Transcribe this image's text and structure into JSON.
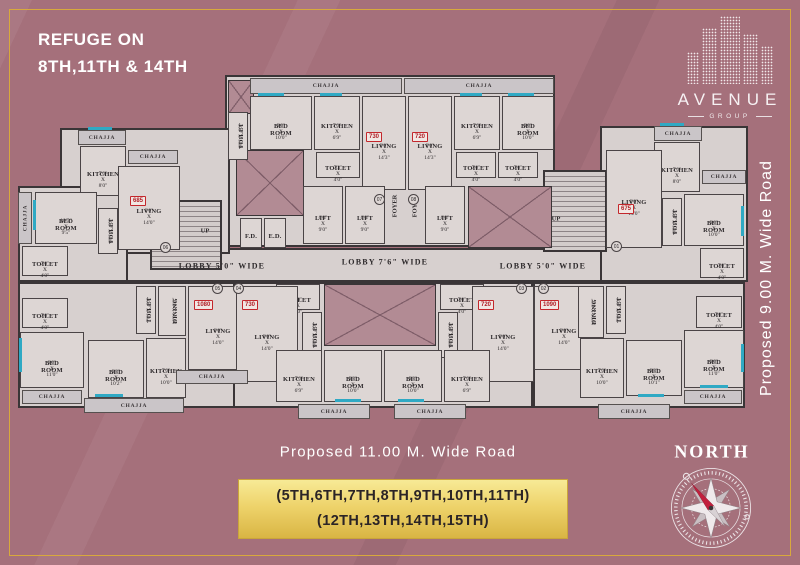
{
  "header": {
    "refuge_line1": "REFUGE ON",
    "refuge_line2": "8TH,11TH & 14TH"
  },
  "logo": {
    "name": "AVENUE",
    "sub": "GROUP"
  },
  "roads": {
    "right": "Proposed 9.00 M. Wide Road",
    "bottom": "Proposed 11.00 M. Wide Road"
  },
  "banner": {
    "line1": "(5TH,6TH,7TH,8TH,9TH,10TH,11TH)",
    "line2": "(12TH,13TH,14TH,15TH)"
  },
  "compass": {
    "label": "NORTH"
  },
  "colors": {
    "background": "#a5707b",
    "gold_frame": "#d8a93c",
    "wall": "#3a3537",
    "floor": "#d7d0cf",
    "room": "#ddd6d4",
    "chajja": "#cac5c8",
    "shaft": "#b28b94",
    "area_red": "#c3272c",
    "window_teal": "#2fa9c4",
    "banner_gold": "#eed36b"
  },
  "plan": {
    "chajja_label": "CHAJJA",
    "blocks": [
      {
        "x": 225,
        "y": 75,
        "w": 330,
        "h": 172
      },
      {
        "x": 85,
        "y": 248,
        "w": 580,
        "h": 34
      },
      {
        "x": 60,
        "y": 128,
        "w": 170,
        "h": 126
      },
      {
        "x": 18,
        "y": 186,
        "w": 110,
        "h": 96
      },
      {
        "x": 18,
        "y": 282,
        "w": 230,
        "h": 126
      },
      {
        "x": 233,
        "y": 282,
        "w": 300,
        "h": 126
      },
      {
        "x": 533,
        "y": 282,
        "w": 212,
        "h": 126
      },
      {
        "x": 600,
        "y": 126,
        "w": 148,
        "h": 156
      },
      {
        "x": 150,
        "y": 200,
        "w": 72,
        "h": 70,
        "kind": "stairs"
      },
      {
        "x": 543,
        "y": 170,
        "w": 64,
        "h": 82,
        "kind": "stairs"
      }
    ],
    "shafts": [
      {
        "x": 228,
        "y": 80,
        "w": 26,
        "h": 34
      },
      {
        "x": 236,
        "y": 150,
        "w": 68,
        "h": 66
      },
      {
        "x": 468,
        "y": 186,
        "w": 84,
        "h": 62
      },
      {
        "x": 324,
        "y": 284,
        "w": 112,
        "h": 62
      }
    ],
    "rooms": [
      {
        "label": "BED ROOM",
        "dims": "9'0\" X 10'0\"",
        "x": 250,
        "y": 96,
        "w": 62,
        "h": 54
      },
      {
        "label": "KITCHEN",
        "dims": "7'0\" X 6'9\"",
        "x": 314,
        "y": 96,
        "w": 46,
        "h": 54
      },
      {
        "label": "LIVING",
        "dims": "9'0\" X 14'3\"",
        "x": 362,
        "y": 96,
        "w": 44,
        "h": 94
      },
      {
        "label": "TOILET",
        "dims": "7'3\" X 4'0\"",
        "x": 316,
        "y": 152,
        "w": 44,
        "h": 26
      },
      {
        "label": "TOILET",
        "dims": "6'0\" X 4'0\"",
        "x": 228,
        "y": 112,
        "w": 20,
        "h": 48,
        "vert": true
      },
      {
        "label": "LIVING",
        "dims": "9'0\" X 14'3\"",
        "x": 408,
        "y": 96,
        "w": 44,
        "h": 94
      },
      {
        "label": "KITCHEN",
        "dims": "7'0\" X 6'9\"",
        "x": 454,
        "y": 96,
        "w": 46,
        "h": 54
      },
      {
        "label": "BED ROOM",
        "dims": "9'0\" X 10'0\"",
        "x": 502,
        "y": 96,
        "w": 52,
        "h": 54
      },
      {
        "label": "TOILET",
        "dims": "7'0\" X 4'0\"",
        "x": 456,
        "y": 152,
        "w": 40,
        "h": 26
      },
      {
        "label": "TOILET",
        "dims": "7'0\" X 4'0\"",
        "x": 498,
        "y": 152,
        "w": 40,
        "h": 26
      },
      {
        "label": "LIFT",
        "dims": "6'0\" X 9'0\"",
        "x": 303,
        "y": 186,
        "w": 40,
        "h": 58
      },
      {
        "label": "LIFT",
        "dims": "6'0\" X 9'0\"",
        "x": 345,
        "y": 186,
        "w": 40,
        "h": 58
      },
      {
        "label": "LIFT",
        "dims": "6'0\" X 9'0\"",
        "x": 425,
        "y": 186,
        "w": 40,
        "h": 58
      },
      {
        "label": "F.D.",
        "dims": "",
        "x": 240,
        "y": 218,
        "w": 22,
        "h": 30
      },
      {
        "label": "E.D.",
        "dims": "",
        "x": 264,
        "y": 218,
        "w": 22,
        "h": 30
      },
      {
        "label": "KITCHEN",
        "dims": "7'0\" X 8'0\"",
        "x": 80,
        "y": 146,
        "w": 46,
        "h": 50
      },
      {
        "label": "LIVING",
        "dims": "9'0\" X 14'0\"",
        "x": 118,
        "y": 166,
        "w": 62,
        "h": 84
      },
      {
        "label": "BED ROOM",
        "dims": "10'5\" X 9'5\"",
        "x": 35,
        "y": 192,
        "w": 62,
        "h": 52
      },
      {
        "label": "TOILET",
        "dims": "6'0\" X 4'0\"",
        "x": 98,
        "y": 208,
        "w": 20,
        "h": 46,
        "vert": true
      },
      {
        "label": "TOILET",
        "dims": "7'0\" X 4'0\"",
        "x": 22,
        "y": 246,
        "w": 46,
        "h": 30
      },
      {
        "label": "TOILET",
        "dims": "7'0\" X 4'0\"",
        "x": 22,
        "y": 298,
        "w": 46,
        "h": 30
      },
      {
        "label": "BED ROOM",
        "dims": "9'0\" X 11'0\"",
        "x": 20,
        "y": 332,
        "w": 64,
        "h": 56
      },
      {
        "label": "BED ROOM",
        "dims": "9'3\" X 10'2\"",
        "x": 88,
        "y": 340,
        "w": 56,
        "h": 58
      },
      {
        "label": "KITCHEN",
        "dims": "7'0\" X 10'0\"",
        "x": 146,
        "y": 338,
        "w": 40,
        "h": 60
      },
      {
        "label": "DINING",
        "dims": "10'3\" X 8'0\"",
        "x": 158,
        "y": 286,
        "w": 28,
        "h": 50,
        "vert": true
      },
      {
        "label": "TOILET",
        "dims": "7'0\" X 4'0\"",
        "x": 136,
        "y": 286,
        "w": 20,
        "h": 48,
        "vert": true
      },
      {
        "label": "LIVING",
        "dims": "9'0\" X 14'0\"",
        "x": 188,
        "y": 286,
        "w": 60,
        "h": 84
      },
      {
        "label": "TOILET",
        "dims": "7'0\" X 4'0\"",
        "x": 276,
        "y": 284,
        "w": 44,
        "h": 26
      },
      {
        "label": "TOILET",
        "dims": "7'0\" X 4'0\"",
        "x": 440,
        "y": 284,
        "w": 44,
        "h": 26
      },
      {
        "label": "TOILET",
        "dims": "6'0\" X 4'0\"",
        "x": 302,
        "y": 312,
        "w": 20,
        "h": 46,
        "vert": true
      },
      {
        "label": "TOILET",
        "dims": "6'0\" X 4'0\"",
        "x": 438,
        "y": 312,
        "w": 20,
        "h": 46,
        "vert": true
      },
      {
        "label": "LIVING",
        "dims": "9'0\" X 14'0\"",
        "x": 236,
        "y": 286,
        "w": 62,
        "h": 96
      },
      {
        "label": "LIVING",
        "dims": "9'0\" X 14'0\"",
        "x": 472,
        "y": 286,
        "w": 62,
        "h": 96
      },
      {
        "label": "KITCHEN",
        "dims": "7'0\" X 6'9\"",
        "x": 276,
        "y": 350,
        "w": 46,
        "h": 52
      },
      {
        "label": "BED ROOM",
        "dims": "9'3\" X 10'0\"",
        "x": 324,
        "y": 350,
        "w": 58,
        "h": 52
      },
      {
        "label": "BED ROOM",
        "dims": "9'3\" X 10'0\"",
        "x": 384,
        "y": 350,
        "w": 58,
        "h": 52
      },
      {
        "label": "KITCHEN",
        "dims": "7'0\" X 6'9\"",
        "x": 444,
        "y": 350,
        "w": 46,
        "h": 52
      },
      {
        "label": "LIVING",
        "dims": "9'0\" X 14'0\"",
        "x": 534,
        "y": 286,
        "w": 60,
        "h": 84
      },
      {
        "label": "DINING",
        "dims": "10'3\" X 8'0\"",
        "x": 578,
        "y": 286,
        "w": 26,
        "h": 52,
        "vert": true
      },
      {
        "label": "TOILET",
        "dims": "7'0\" X 4'0\"",
        "x": 606,
        "y": 286,
        "w": 20,
        "h": 48,
        "vert": true
      },
      {
        "label": "TOILET",
        "dims": "7'0\" X 4'0\"",
        "x": 696,
        "y": 296,
        "w": 46,
        "h": 32
      },
      {
        "label": "KITCHEN",
        "dims": "7'0\" X 10'0\"",
        "x": 580,
        "y": 338,
        "w": 44,
        "h": 60
      },
      {
        "label": "BED ROOM",
        "dims": "9'3\" X 10'1\"",
        "x": 626,
        "y": 340,
        "w": 56,
        "h": 56
      },
      {
        "label": "BED ROOM",
        "dims": "9'0\" X 11'0\"",
        "x": 684,
        "y": 330,
        "w": 60,
        "h": 58
      },
      {
        "label": "KITCHEN",
        "dims": "7'0\" X 8'0\"",
        "x": 654,
        "y": 142,
        "w": 46,
        "h": 50
      },
      {
        "label": "LIVING",
        "dims": "9'0\" X 14'0\"",
        "x": 606,
        "y": 150,
        "w": 56,
        "h": 98
      },
      {
        "label": "BED ROOM",
        "dims": "9'0\" X 10'0\"",
        "x": 684,
        "y": 194,
        "w": 60,
        "h": 52
      },
      {
        "label": "TOILET",
        "dims": "6'0\" X 4'0\"",
        "x": 662,
        "y": 198,
        "w": 20,
        "h": 48,
        "vert": true
      },
      {
        "label": "TOILET",
        "dims": "7'0\" X 4'0\"",
        "x": 700,
        "y": 248,
        "w": 44,
        "h": 30
      }
    ],
    "chajjas": [
      {
        "x": 250,
        "y": 78,
        "w": 152,
        "h": 16
      },
      {
        "x": 404,
        "y": 78,
        "w": 150,
        "h": 16
      },
      {
        "x": 78,
        "y": 130,
        "w": 48,
        "h": 15
      },
      {
        "x": 128,
        "y": 150,
        "w": 50,
        "h": 14
      },
      {
        "x": 18,
        "y": 192,
        "w": 14,
        "h": 52,
        "vert": true
      },
      {
        "x": 22,
        "y": 390,
        "w": 60,
        "h": 14
      },
      {
        "x": 84,
        "y": 398,
        "w": 100,
        "h": 15
      },
      {
        "x": 176,
        "y": 370,
        "w": 72,
        "h": 14
      },
      {
        "x": 298,
        "y": 404,
        "w": 72,
        "h": 15
      },
      {
        "x": 394,
        "y": 404,
        "w": 72,
        "h": 15
      },
      {
        "x": 598,
        "y": 404,
        "w": 72,
        "h": 15
      },
      {
        "x": 684,
        "y": 390,
        "w": 58,
        "h": 14
      },
      {
        "x": 654,
        "y": 126,
        "w": 48,
        "h": 15
      },
      {
        "x": 702,
        "y": 170,
        "w": 44,
        "h": 14
      }
    ],
    "windows": [
      {
        "x": 258,
        "y": 93,
        "w": 26,
        "h": 3
      },
      {
        "x": 320,
        "y": 93,
        "w": 22,
        "h": 3
      },
      {
        "x": 460,
        "y": 93,
        "w": 22,
        "h": 3
      },
      {
        "x": 508,
        "y": 93,
        "w": 26,
        "h": 3
      },
      {
        "x": 88,
        "y": 127,
        "w": 24,
        "h": 3
      },
      {
        "x": 660,
        "y": 123,
        "w": 24,
        "h": 3
      },
      {
        "x": 33,
        "y": 200,
        "w": 3,
        "h": 30
      },
      {
        "x": 19,
        "y": 338,
        "w": 3,
        "h": 34
      },
      {
        "x": 95,
        "y": 394,
        "w": 28,
        "h": 3
      },
      {
        "x": 335,
        "y": 399,
        "w": 26,
        "h": 3
      },
      {
        "x": 398,
        "y": 399,
        "w": 26,
        "h": 3
      },
      {
        "x": 638,
        "y": 394,
        "w": 26,
        "h": 3
      },
      {
        "x": 700,
        "y": 385,
        "w": 28,
        "h": 3
      },
      {
        "x": 741,
        "y": 206,
        "w": 3,
        "h": 30
      },
      {
        "x": 741,
        "y": 344,
        "w": 3,
        "h": 28
      }
    ],
    "badges": [
      {
        "text": "730",
        "x": 366,
        "y": 132
      },
      {
        "text": "720",
        "x": 412,
        "y": 132
      },
      {
        "text": "685",
        "x": 130,
        "y": 196
      },
      {
        "text": "675",
        "x": 618,
        "y": 204
      },
      {
        "text": "1080",
        "x": 194,
        "y": 300
      },
      {
        "text": "730",
        "x": 242,
        "y": 300
      },
      {
        "text": "720",
        "x": 478,
        "y": 300
      },
      {
        "text": "1090",
        "x": 540,
        "y": 300
      }
    ],
    "circles": [
      {
        "text": "07",
        "x": 374,
        "y": 194
      },
      {
        "text": "08",
        "x": 408,
        "y": 194
      },
      {
        "text": "06",
        "x": 160,
        "y": 242
      },
      {
        "text": "01",
        "x": 611,
        "y": 241
      },
      {
        "text": "05",
        "x": 212,
        "y": 283
      },
      {
        "text": "04",
        "x": 233,
        "y": 283
      },
      {
        "text": "03",
        "x": 516,
        "y": 283
      },
      {
        "text": "02",
        "x": 538,
        "y": 283
      }
    ],
    "lobbies": [
      {
        "text": "LOBBY 5'0\" WIDE",
        "x": 222,
        "y": 266
      },
      {
        "text": "LOBBY 7'6\" WIDE",
        "x": 385,
        "y": 262
      },
      {
        "text": "LOBBY 5'0\" WIDE",
        "x": 543,
        "y": 266
      }
    ],
    "misc": [
      {
        "text": "UP",
        "x": 205,
        "y": 231
      },
      {
        "text": "UP",
        "x": 556,
        "y": 219
      },
      {
        "text": "FOYER",
        "x": 395,
        "y": 206,
        "vert": true
      },
      {
        "text": "FOYER",
        "x": 415,
        "y": 206,
        "vert": true
      }
    ]
  }
}
